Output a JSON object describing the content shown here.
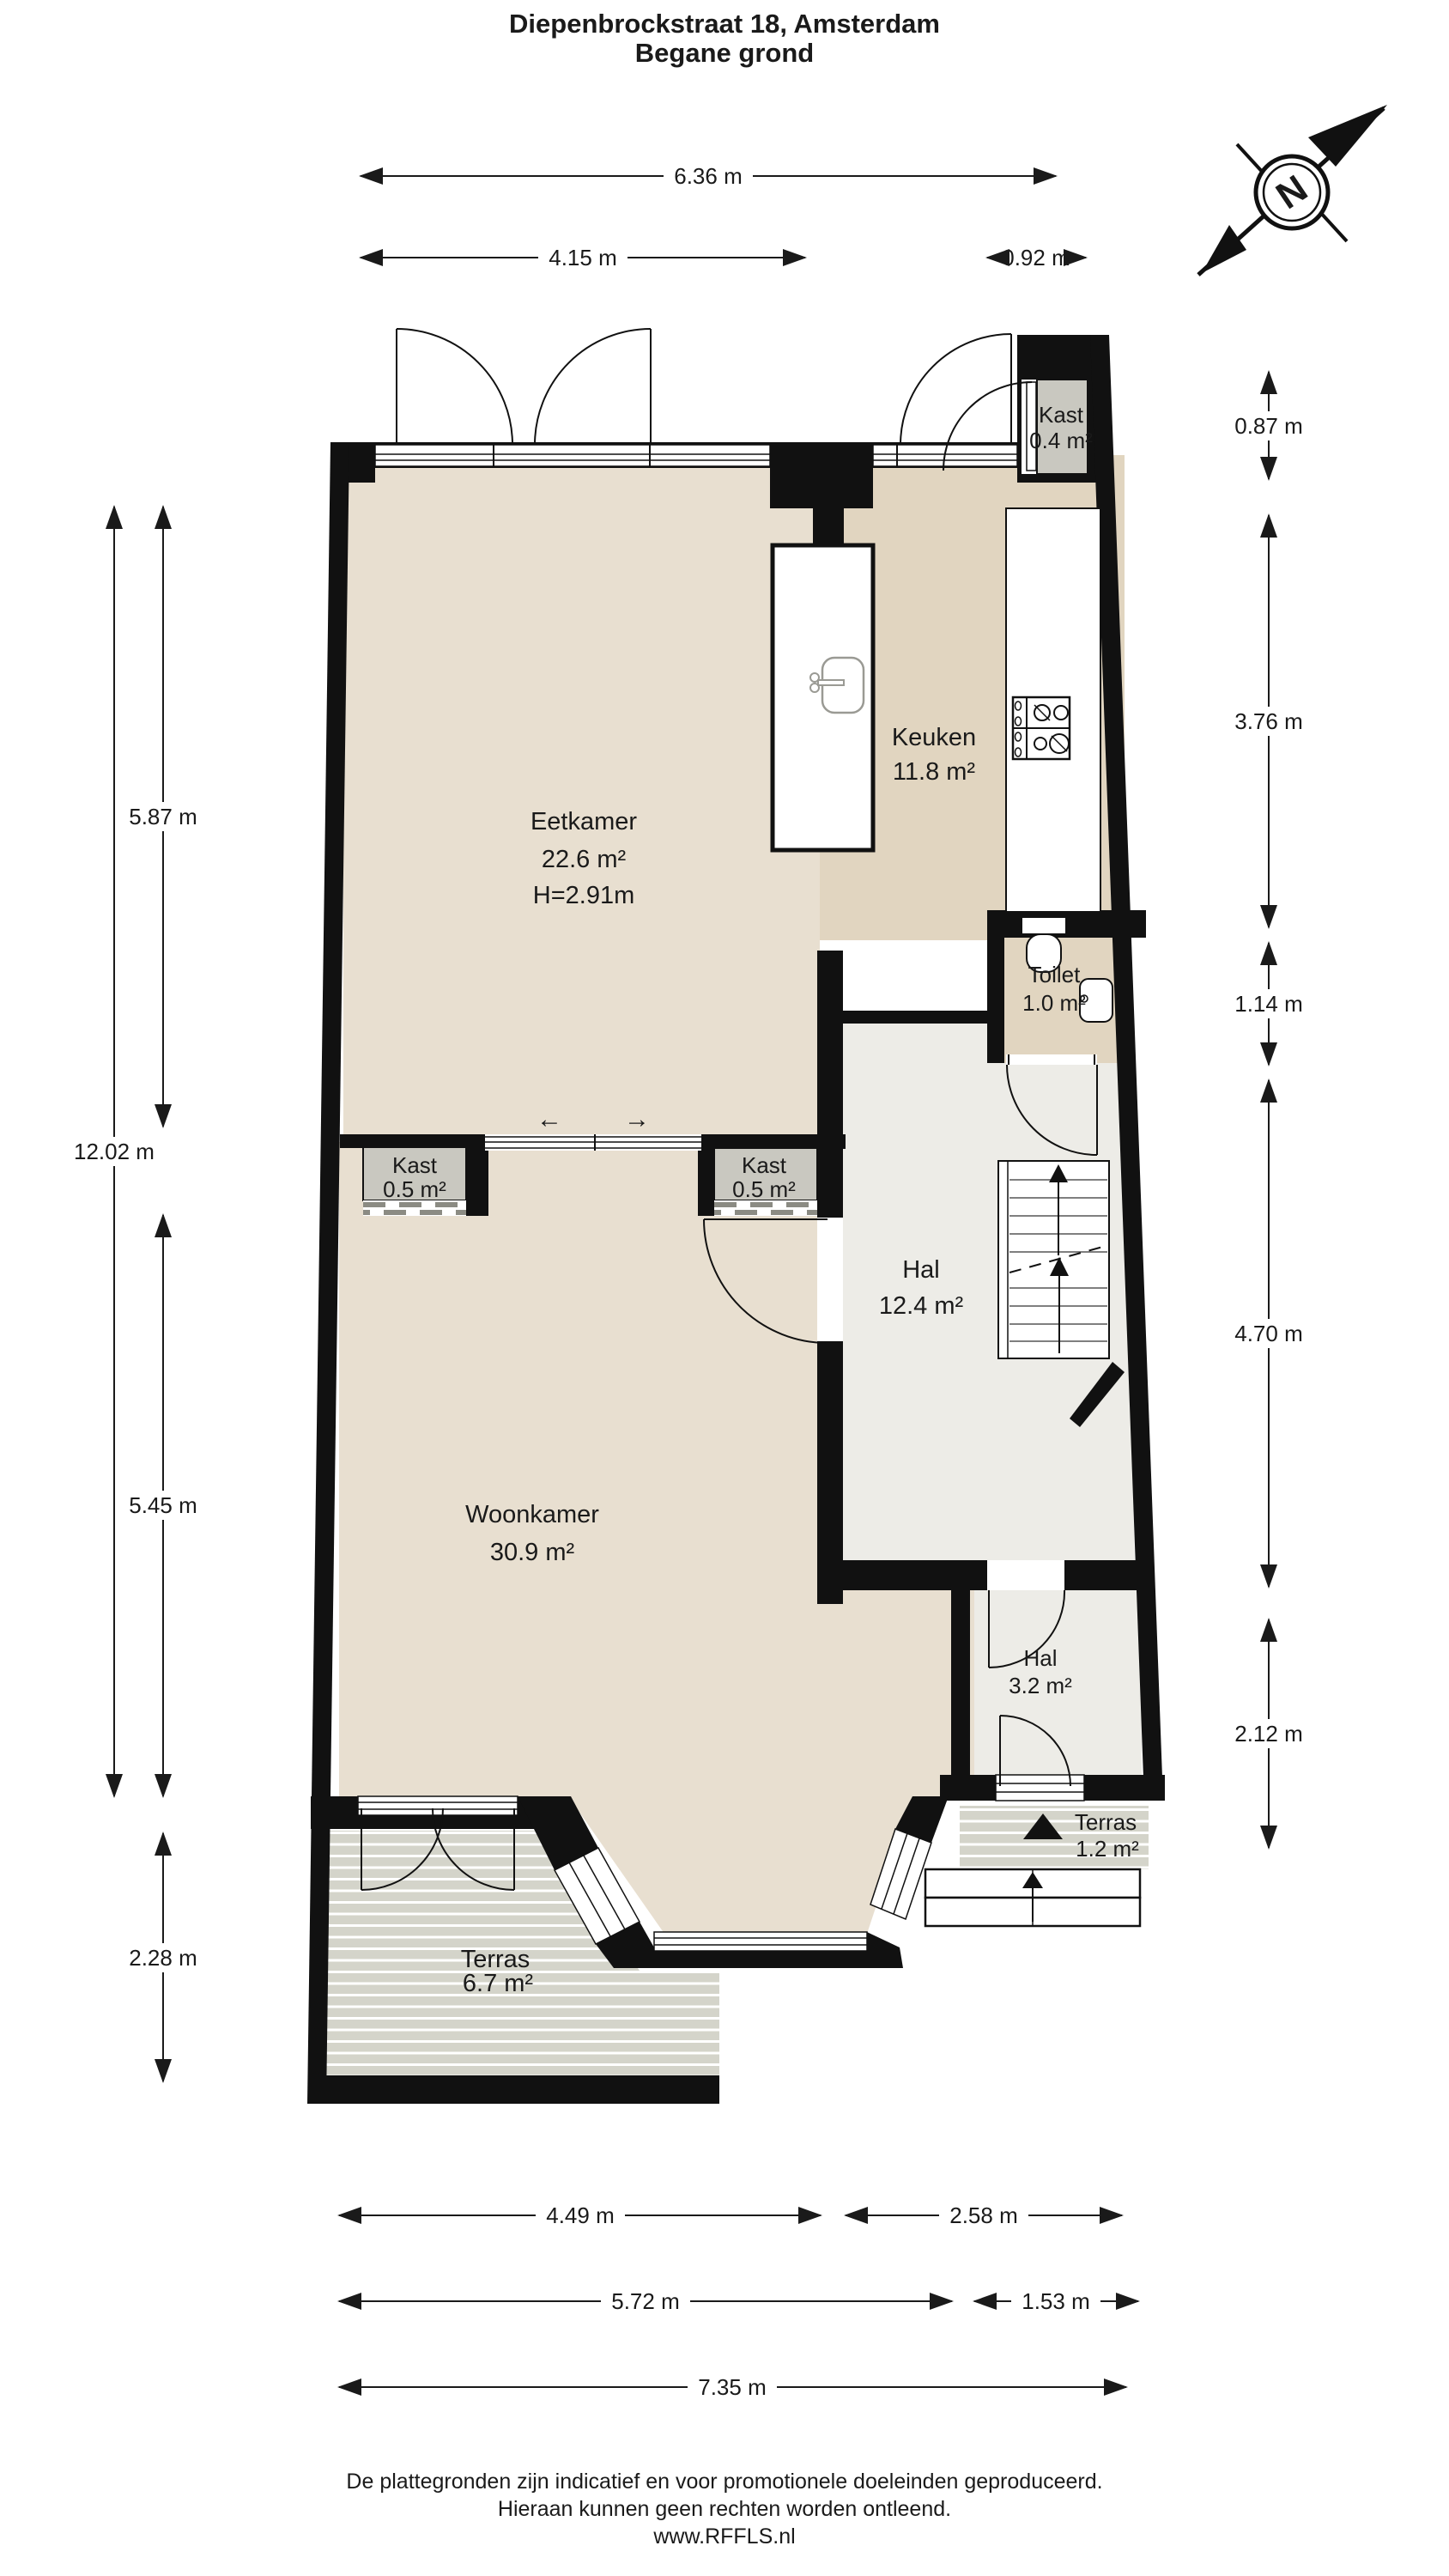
{
  "title": {
    "line1": "Diepenbrockstraat 18, Amsterdam",
    "line2": "Begane grond"
  },
  "compass": {
    "north": "N"
  },
  "rooms": {
    "kast_top": {
      "name": "Kast",
      "area": "0.4 m²"
    },
    "keuken": {
      "name": "Keuken",
      "area": "11.8 m²"
    },
    "eetkamer": {
      "name": "Eetkamer",
      "area": "22.6 m²",
      "height": "H=2.91m"
    },
    "toilet": {
      "name": "Toilet",
      "area": "1.0 m²"
    },
    "kast_left": {
      "name": "Kast",
      "area": "0.5 m²"
    },
    "kast_right": {
      "name": "Kast",
      "area": "0.5 m²"
    },
    "hal": {
      "name": "Hal",
      "area": "12.4 m²"
    },
    "woonkamer": {
      "name": "Woonkamer",
      "area": "30.9 m²"
    },
    "hal_small": {
      "name": "Hal",
      "area": "3.2 m²"
    },
    "terras_small": {
      "name": "Terras",
      "area": "1.2 m²"
    },
    "terras_large": {
      "name": "Terras",
      "area": "6.7 m²"
    }
  },
  "sliding_door": {
    "left_arrow": "←",
    "right_arrow": "→"
  },
  "dimensions": {
    "top": [
      {
        "label": "6.36 m"
      },
      {
        "label": "4.15 m"
      },
      {
        "label": "0.92 m"
      }
    ],
    "left": [
      {
        "label": "12.02 m"
      },
      {
        "label": "5.87 m"
      },
      {
        "label": "5.45 m"
      },
      {
        "label": "2.28 m"
      }
    ],
    "right": [
      {
        "label": "0.87 m"
      },
      {
        "label": "3.76 m"
      },
      {
        "label": "1.14 m"
      },
      {
        "label": "4.70 m"
      },
      {
        "label": "2.12 m"
      }
    ],
    "bottom": [
      {
        "label": "4.49 m"
      },
      {
        "label": "2.58 m"
      },
      {
        "label": "5.72 m"
      },
      {
        "label": "1.53 m"
      },
      {
        "label": "7.35 m"
      }
    ]
  },
  "footer": {
    "line1": "De plattegronden zijn indicatief en voor promotionele doeleinden geproduceerd.",
    "line2": "Hieraan kunnen geen rechten worden ontleend.",
    "line3": "www.RFFLS.nl"
  },
  "colors": {
    "wall": "#111111",
    "floor_light": "#e8dfd0",
    "floor_dark": "#e1d5c0",
    "floor_hall": "#edece7",
    "closet": "#c9c8c0",
    "deck": "#d4d4ca"
  }
}
